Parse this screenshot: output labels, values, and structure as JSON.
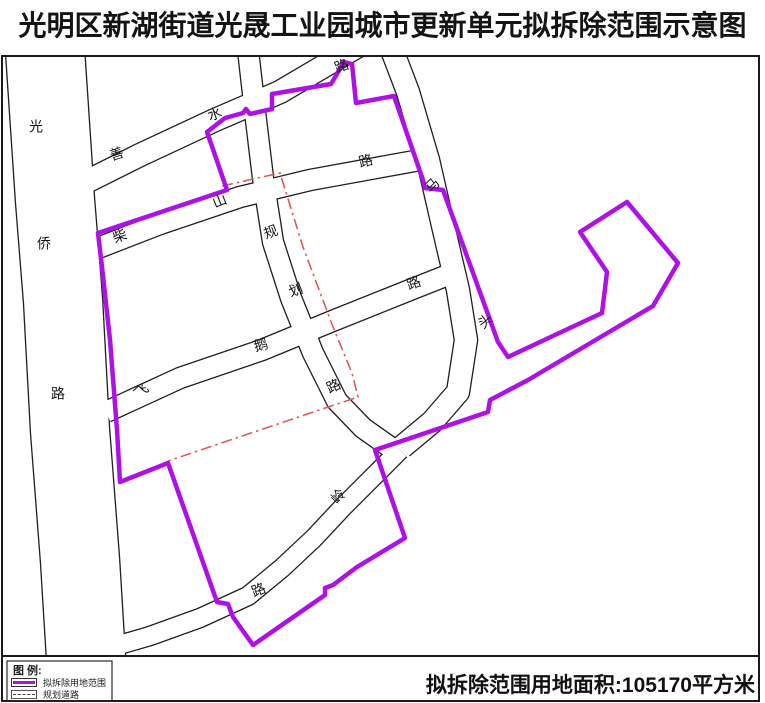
{
  "title": "光明区新湖街道光晟工业园城市更新单元拟拆除范围示意图",
  "footer": {
    "legend_heading": "图 例:",
    "legend_items": [
      {
        "label": "拟拆除用地范围",
        "symbol": "demolition-boundary-swatch"
      },
      {
        "label": "规划道路",
        "symbol": "planned-road-swatch"
      }
    ],
    "area_note": "拟拆除范围用地面积:105170平方米"
  },
  "colors": {
    "boundary": "#ae10e8",
    "planned_road": "#e05a5a",
    "line": "#1f1f1f",
    "road_fill": "#ffffff",
    "text": "#161616"
  },
  "geometry": {
    "frame": [
      2,
      56,
      757,
      600
    ],
    "footer_band": [
      2,
      656,
      757,
      45
    ],
    "legend_box": [
      7,
      661,
      105,
      40
    ],
    "roads": [
      {
        "name": "guangqiao-road",
        "w": 78,
        "pts": [
          [
            45,
            50
          ],
          [
            55,
            200
          ],
          [
            63,
            300
          ],
          [
            70,
            430
          ],
          [
            80,
            560
          ],
          [
            86,
            658
          ]
        ]
      },
      {
        "name": "shanshui-road",
        "w": 22,
        "pts": [
          [
            58,
            196
          ],
          [
            140,
            155
          ],
          [
            215,
            120
          ],
          [
            280,
            92
          ],
          [
            358,
            46
          ]
        ]
      },
      {
        "name": "chaishan-road",
        "w": 20,
        "pts": [
          [
            80,
            255
          ],
          [
            160,
            224
          ],
          [
            240,
            197
          ],
          [
            310,
            180
          ],
          [
            420,
            160
          ]
        ]
      },
      {
        "name": "matou-road",
        "w": 22,
        "pts": [
          [
            392,
            50
          ],
          [
            408,
            92
          ],
          [
            428,
            160
          ],
          [
            444,
            230
          ],
          [
            458,
            290
          ],
          [
            466,
            340
          ],
          [
            458,
            392
          ],
          [
            432,
            422
          ],
          [
            402,
            447
          ]
        ]
      },
      {
        "name": "guihua-road",
        "w": 20,
        "pts": [
          [
            248,
            50
          ],
          [
            256,
            120
          ],
          [
            263,
            178
          ],
          [
            273,
            242
          ],
          [
            291,
            298
          ],
          [
            313,
            353
          ],
          [
            337,
            401
          ],
          [
            363,
            428
          ],
          [
            390,
            447
          ]
        ]
      },
      {
        "name": "feie-road",
        "w": 20,
        "pts": [
          [
            106,
            412
          ],
          [
            180,
            378
          ],
          [
            262,
            350
          ],
          [
            330,
            322
          ],
          [
            415,
            288
          ],
          [
            458,
            271
          ]
        ]
      },
      {
        "name": "ling-road",
        "w": 18,
        "pts": [
          [
            400,
            450
          ],
          [
            372,
            478
          ],
          [
            344,
            506
          ],
          [
            314,
            538
          ],
          [
            282,
            568
          ],
          [
            248,
            596
          ],
          [
            200,
            618
          ],
          [
            150,
            636
          ],
          [
            95,
            652
          ],
          [
            50,
            660
          ]
        ]
      }
    ],
    "boundary": [
      [
        207,
        132
      ],
      [
        225,
        118
      ],
      [
        243,
        113
      ],
      [
        246,
        109
      ],
      [
        250,
        114
      ],
      [
        272,
        109
      ],
      [
        272,
        94
      ],
      [
        331,
        84
      ],
      [
        344,
        62
      ],
      [
        352,
        64
      ],
      [
        356,
        103
      ],
      [
        394,
        96
      ],
      [
        423,
        180
      ],
      [
        425,
        188
      ],
      [
        443,
        190
      ],
      [
        498,
        342
      ],
      [
        508,
        357
      ],
      [
        602,
        313
      ],
      [
        607,
        272
      ],
      [
        580,
        232
      ],
      [
        627,
        202
      ],
      [
        678,
        263
      ],
      [
        653,
        306
      ],
      [
        528,
        380
      ],
      [
        490,
        400
      ],
      [
        488,
        412
      ],
      [
        375,
        450
      ],
      [
        405,
        538
      ],
      [
        357,
        567
      ],
      [
        333,
        585
      ],
      [
        325,
        588
      ],
      [
        325,
        595
      ],
      [
        253,
        645
      ],
      [
        233,
        617
      ],
      [
        228,
        604
      ],
      [
        217,
        602
      ],
      [
        168,
        463
      ],
      [
        120,
        482
      ],
      [
        117,
        430
      ],
      [
        110,
        340
      ],
      [
        102,
        267
      ],
      [
        98,
        233
      ],
      [
        227,
        190
      ]
    ],
    "planned": [
      [
        [
          222,
          186
        ],
        [
          280,
          173
        ],
        [
          303,
          247
        ],
        [
          333,
          327
        ],
        [
          352,
          373
        ],
        [
          358,
          397
        ],
        [
          168,
          461
        ]
      ]
    ],
    "labels": [
      [
        "光",
        36,
        128,
        0
      ],
      [
        "侨",
        44,
        245,
        0
      ],
      [
        "路",
        58,
        395,
        0
      ],
      [
        "善",
        117,
        155,
        -18
      ],
      [
        "水",
        215,
        115,
        -20
      ],
      [
        "路",
        342,
        67,
        -22
      ],
      [
        "柴",
        120,
        237,
        -20
      ],
      [
        "山",
        220,
        202,
        -22
      ],
      [
        "路",
        366,
        162,
        -14
      ],
      [
        "马",
        433,
        186,
        -45
      ],
      [
        "头",
        486,
        322,
        -40
      ],
      [
        "规",
        271,
        233,
        -20
      ],
      [
        "划",
        296,
        291,
        -20
      ],
      [
        "路",
        334,
        387,
        -25
      ],
      [
        "飞",
        142,
        392,
        -42
      ],
      [
        "鹅",
        261,
        346,
        -15
      ],
      [
        "路",
        414,
        284,
        -20
      ],
      [
        "岭",
        339,
        497,
        -48
      ],
      [
        "路",
        259,
        591,
        -22
      ]
    ]
  }
}
